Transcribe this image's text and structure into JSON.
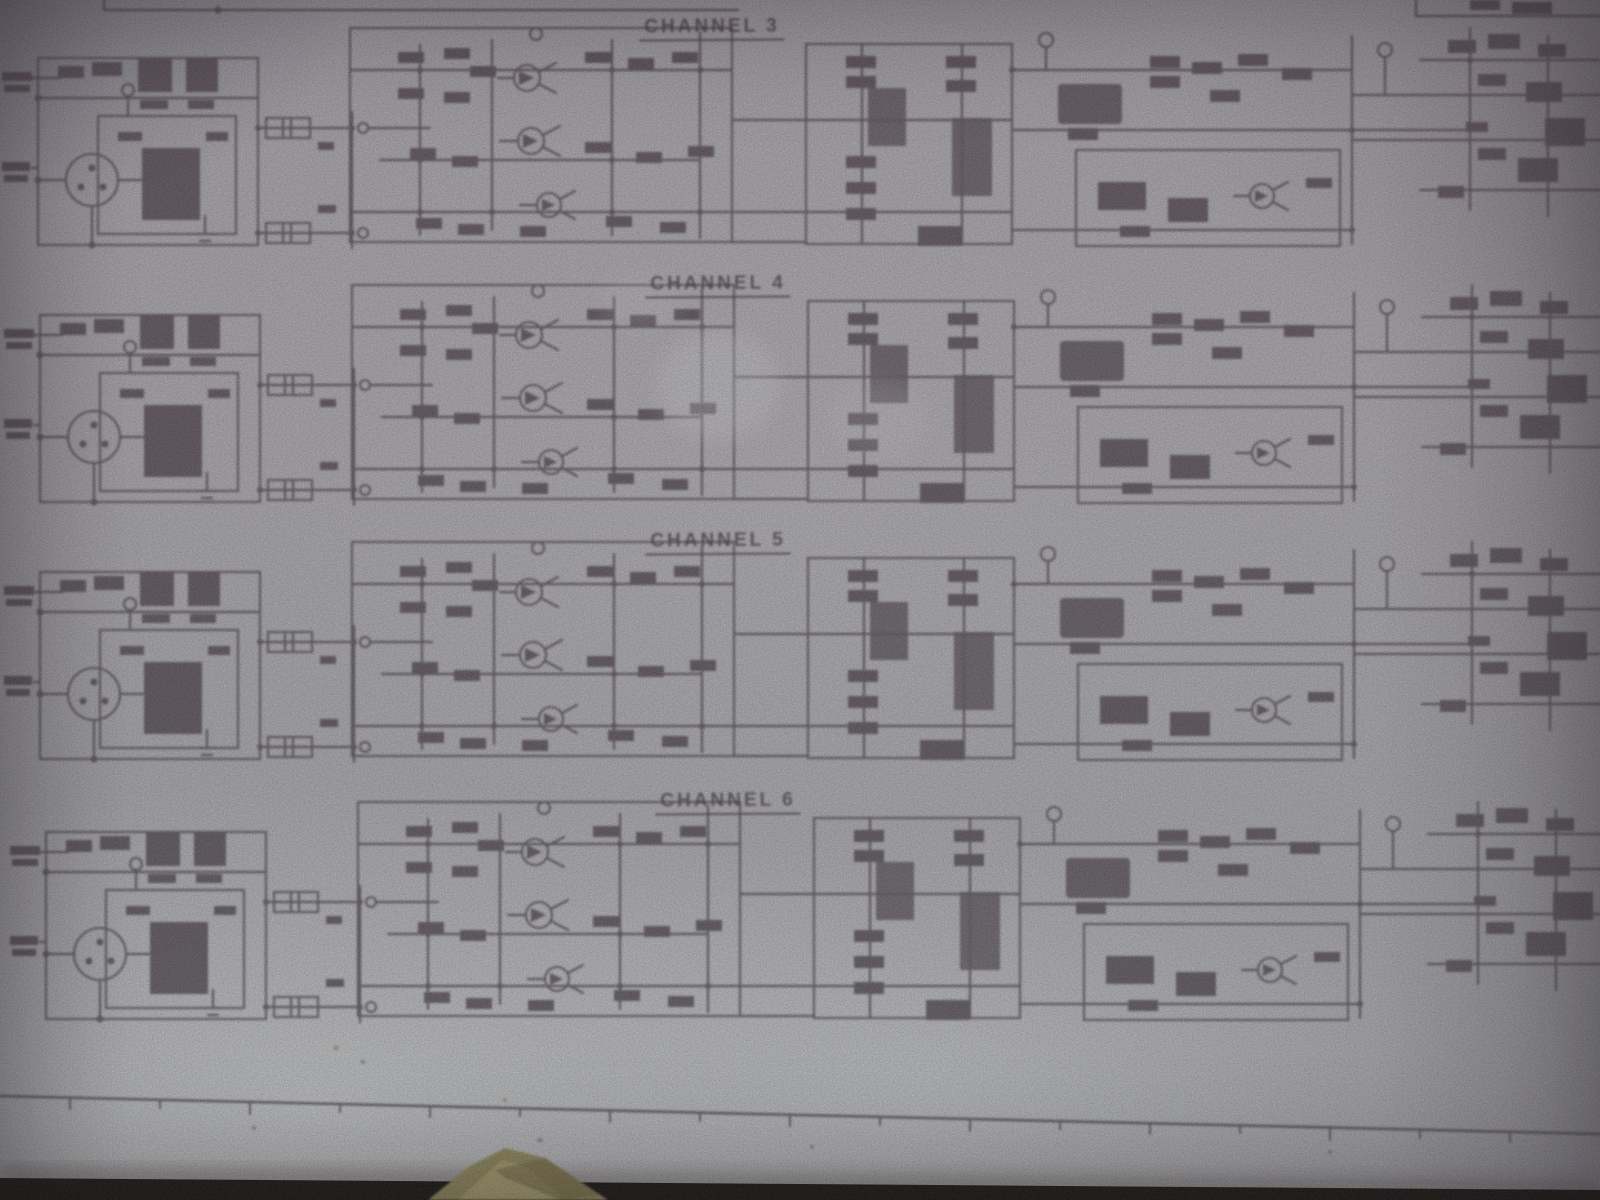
{
  "channels": [
    {
      "label": "CHANNEL 3"
    },
    {
      "label": "CHANNEL 4"
    },
    {
      "label": "CHANNEL 5"
    },
    {
      "label": "CHANNEL 6"
    }
  ],
  "colors": {
    "paper": "#a5a3a7",
    "ink": "#463c43",
    "table": "#140e0a",
    "object": "#8e8354"
  }
}
